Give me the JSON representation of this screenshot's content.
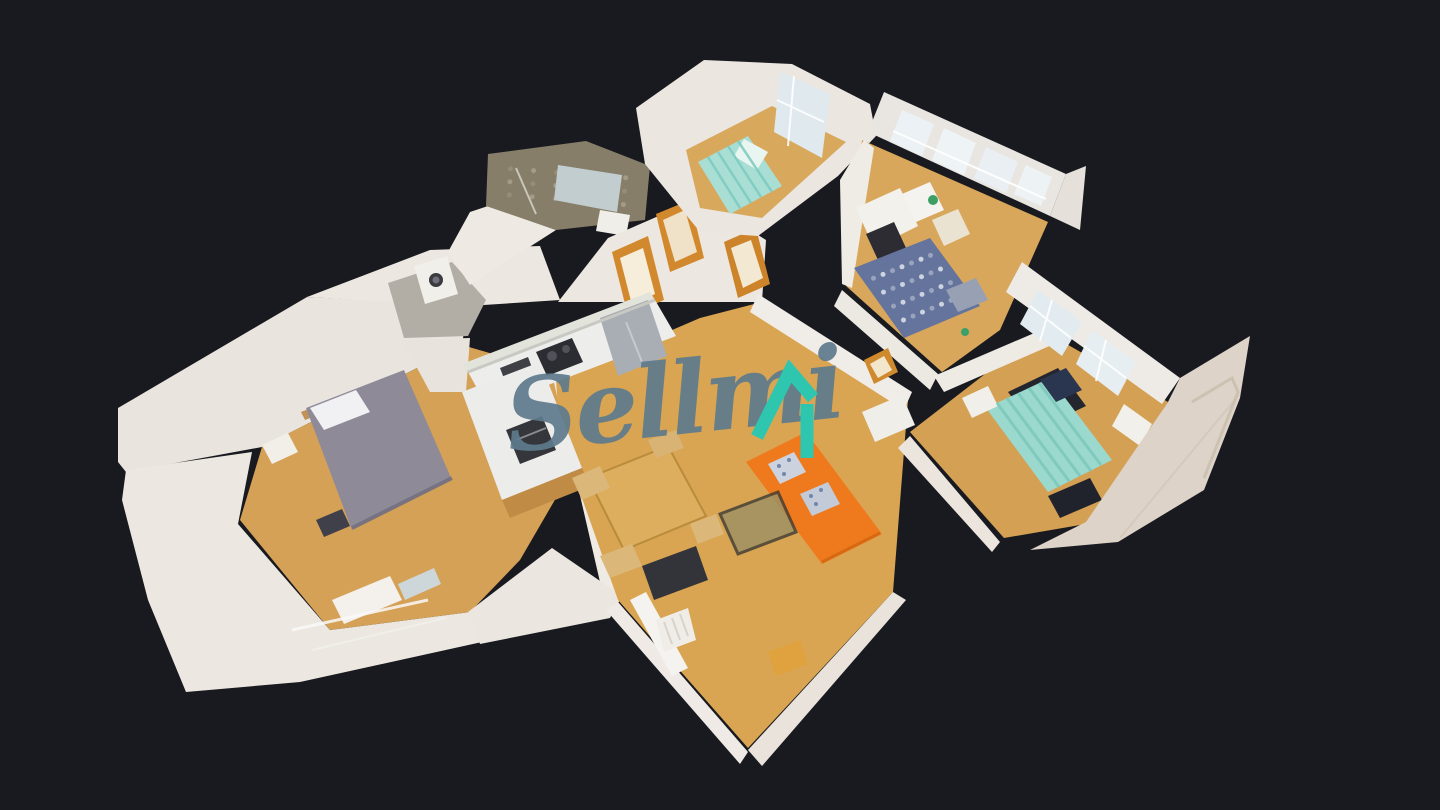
{
  "app": {
    "name": "3D dollhouse property tour viewer"
  },
  "canvas": {
    "width": 1440,
    "height": 810,
    "background": "#191a1f"
  },
  "watermark": {
    "text": "Sellmi",
    "text_color": "#5e7b8d",
    "icon_color": "#2fc6b0",
    "icon_roof_points": "757,437 790,371 813,398",
    "icon_bar_points": "807,404 807,458",
    "icon_stroke_width": 13
  },
  "scene": {
    "shapes": [
      {
        "n": "ext-wall-bedroom-nw",
        "p": "118,408 307,297 468,305 462,345 262,447 126,472 118,462",
        "f": "#e9e4de"
      },
      {
        "n": "ext-wall-bedroom-sw",
        "p": "252,452 238,524 330,630 470,612 482,642 300,682 186,692 148,600 122,500 126,470",
        "f": "#ece7e0"
      },
      {
        "n": "bedroom-floor",
        "p": "262,447 462,345 555,372 585,448 520,560 470,612 330,630 240,520",
        "f": "#d5a156"
      },
      {
        "n": "bed-headboard",
        "p": "301,412 402,372 406,380 305,420",
        "f": "#c19258"
      },
      {
        "n": "master-bed",
        "p": "306,408 404,370 452,480 352,530",
        "f": "#8f8a98"
      },
      {
        "n": "master-bed-pillows",
        "p": "310,408 356,390 370,412 324,430",
        "f": "#f1f1f3"
      },
      {
        "n": "nightstand-left",
        "p": "262,445 288,433 298,452 272,464",
        "f": "#f2efe9"
      },
      {
        "n": "bag-dark",
        "p": "316,520 342,509 350,526 324,537",
        "f": "#40404a"
      },
      {
        "n": "dresser-south",
        "p": "332,600 390,576 402,600 344,624",
        "f": "#f4f1ec"
      },
      {
        "n": "mirror-leaning",
        "p": "398,584 434,568 441,584 405,600",
        "f": "#cdd6d8"
      },
      {
        "n": "hall-upper-left-wall",
        "p": "307,297 430,250 540,246 560,300 468,306",
        "f": "#ece7e1"
      },
      {
        "n": "entry-floor-gray",
        "p": "388,283 452,262 486,300 468,336 404,338",
        "f": "#b2ada5"
      },
      {
        "n": "washing-machine",
        "p": "414,266 447,256 458,294 425,304",
        "f": "#f1efe9"
      },
      {
        "n": "entry-fill-wall",
        "p": "402,340 470,338 466,392 430,392",
        "f": "#e8e3dd"
      },
      {
        "n": "bedroom-dining-wall",
        "p": "552,374 570,366 626,594 606,608",
        "f": "#efeae4"
      },
      {
        "n": "door-frame-bedroom-outer",
        "p": "536,424 560,412 570,438 546,450",
        "f": "#cf882c"
      },
      {
        "n": "door-frame-bedroom-inner",
        "p": "542,428 556,420 564,436 550,444",
        "f": "#f4ead4"
      },
      {
        "n": "bridge-sw-wall",
        "p": "468,612 552,548 622,596 610,618 480,644",
        "f": "#ebe6e0"
      },
      {
        "n": "bath-lower-wall",
        "p": "470,212 488,206 556,230 470,285 448,252",
        "f": "#eee9e3"
      },
      {
        "n": "bath-tile-wall",
        "p": "488,154 586,141 650,166 645,220 556,230 486,206",
        "f": "#867e69",
        "pat": 1,
        "pc": "#a89f88",
        "pn": [
          7,
          4
        ],
        "pq": "488,154 650,166 645,220 486,206"
      },
      {
        "n": "bath-mirror",
        "p": "558,165 622,175 617,212 554,200",
        "f": "#c2cdd0"
      },
      {
        "n": "bath-sink",
        "p": "600,210 630,215 626,236 596,231",
        "f": "#f0eee8"
      },
      {
        "n": "hall-wall-behind-doors",
        "p": "558,302 608,238 700,198 766,240 762,302 656,302",
        "f": "#ece7e1"
      },
      {
        "n": "door-frame-1-outer",
        "p": "612,252 648,236 664,300 628,316",
        "f": "#d2892e"
      },
      {
        "n": "door-frame-1-inner",
        "p": "620,258 643,248 655,294 632,305",
        "f": "#f6edda"
      },
      {
        "n": "door-frame-2-outer",
        "p": "656,214 690,200 704,258 670,272",
        "f": "#d2892e"
      },
      {
        "n": "door-frame-2-inner",
        "p": "663,220 685,210 697,252 675,262",
        "f": "#efe2c8"
      },
      {
        "n": "door-frame-3-outer",
        "p": "724,242 756,228 770,284 738,298",
        "f": "#cc8329"
      },
      {
        "n": "door-frame-3-inner",
        "p": "731,248 751,240 763,278 743,288",
        "f": "#f3e8d2"
      },
      {
        "n": "living-floor",
        "p": "556,380 700,318 762,302 908,400 893,592 748,748 618,600 560,436",
        "f": "#d9a552"
      },
      {
        "n": "top-room-walls",
        "p": "636,108 704,60 792,64 870,104 876,136 838,176 758,236 700,232 645,164",
        "f": "#ebe6e0"
      },
      {
        "n": "top-room-floor",
        "p": "686,150 772,106 846,142 762,218 700,208",
        "f": "#d8a85c"
      },
      {
        "n": "top-room-window",
        "p": "780,72 830,94 822,158 774,132",
        "f": "#dfe9ee"
      },
      {
        "n": "top-room-bed",
        "p": "698,162 748,136 782,186 730,214",
        "f": "#a8ded4"
      },
      {
        "n": "top-room-pillow",
        "p": "744,139 768,152 757,170 734,156",
        "f": "#e9f5f1"
      },
      {
        "n": "office-window-wall",
        "p": "884,92 1066,174 1050,216 868,132",
        "f": "#e9e6e1"
      },
      {
        "n": "office-window-1",
        "p": "902,110 934,124 922,156 890,141",
        "f": "#ebf1f5"
      },
      {
        "n": "office-window-2",
        "p": "944,128 976,143 964,175 932,160",
        "f": "#eef3f6"
      },
      {
        "n": "office-window-3",
        "p": "986,147 1018,162 1006,193 974,178",
        "f": "#e9eff3"
      },
      {
        "n": "office-window-4",
        "p": "1026,165 1052,177 1041,206 1014,194",
        "f": "#edf2f5"
      },
      {
        "n": "office-right-wall",
        "p": "1066,174 1086,166 1080,230 1050,216",
        "f": "#e5e0da"
      },
      {
        "n": "office-floor",
        "p": "862,140 1048,222 1000,330 942,372 846,286",
        "f": "#d9a75b"
      },
      {
        "n": "office-left-wall",
        "p": "840,180 864,140 874,148 852,288 842,284",
        "f": "#efebe5"
      },
      {
        "n": "office-desk",
        "p": "856,208 900,188 918,226 874,248",
        "f": "#f3f1ec"
      },
      {
        "n": "office-chair",
        "p": "866,234 894,222 906,248 878,260",
        "f": "#2c2c32"
      },
      {
        "n": "office-drawers",
        "p": "902,194 930,182 944,210 916,222",
        "f": "#f5f3ef"
      },
      {
        "n": "wicker-chair",
        "p": "932,220 958,209 970,234 944,246",
        "f": "#eae3d2"
      },
      {
        "n": "office-bed-checker",
        "p": "854,268 930,238 980,306 904,338",
        "f": "#64749c",
        "pat": 1,
        "pc": "#d9dee9",
        "pn": [
          8,
          5
        ]
      },
      {
        "n": "office-bed-pillow",
        "p": "946,290 976,278 988,300 958,312",
        "f": "#98a0b4"
      },
      {
        "n": "living-office-wall",
        "p": "758,294 912,392 904,410 750,312",
        "f": "#f0ece7"
      },
      {
        "n": "corridor-wall",
        "p": "842,290 938,374 930,390 834,306",
        "f": "#ece8e2"
      },
      {
        "n": "corridor-table",
        "p": "862,412 902,395 915,425 875,442",
        "f": "#f0eee9"
      },
      {
        "n": "door-frame-right-outer",
        "p": "864,360 888,348 898,372 874,384",
        "f": "#d08a2e"
      },
      {
        "n": "door-frame-right-inner",
        "p": "870,364 884,356 892,370 878,378",
        "f": "#f2e6cc"
      },
      {
        "n": "right-room-floor",
        "p": "910,432 1042,330 1168,402 1086,524 1004,538",
        "f": "#d4a054"
      },
      {
        "n": "right-rooms-wall",
        "p": "934,376 1046,328 1054,344 944,392",
        "f": "#eeeae4"
      },
      {
        "n": "floor-shadow-1",
        "p": "1008,392 1058,368 1086,406 1036,430",
        "f": "#23262e"
      },
      {
        "n": "floor-shadow-2",
        "p": "1048,496 1090,478 1102,500 1060,518",
        "f": "#20232b"
      },
      {
        "n": "right-bed-teal",
        "p": "986,408 1050,378 1112,460 1048,492",
        "f": "#9bd8cd"
      },
      {
        "n": "right-bed-pillow",
        "p": "1040,380 1066,368 1082,390 1056,402",
        "f": "#2a3550"
      },
      {
        "n": "nightstand-right",
        "p": "962,398 988,386 998,406 972,418",
        "f": "#f1efe9"
      },
      {
        "n": "right-window-wall",
        "p": "1022,262 1180,378 1162,404 1006,292",
        "f": "#eeebe6"
      },
      {
        "n": "right-window-1",
        "p": "1038,290 1082,322 1062,356 1020,324",
        "f": "#e2ebf0"
      },
      {
        "n": "right-window-2",
        "p": "1092,330 1136,362 1118,396 1076,364",
        "f": "#e6eef2"
      },
      {
        "n": "right-radiator",
        "p": "1124,404 1152,424 1140,446 1112,426",
        "f": "#f2f0ea"
      },
      {
        "n": "ext-wall-right",
        "p": "1168,402 1180,378 1250,336 1240,398 1204,490 1118,542 1030,550 1086,522",
        "f": "#ddd3c8"
      },
      {
        "n": "corridor-south-wall",
        "p": "910,436 1000,542 992,552 898,448",
        "f": "#ebe5de"
      },
      {
        "n": "kitchen-backsplash",
        "p": "462,364 650,292 655,300 468,372",
        "f": "#e2e4db"
      },
      {
        "n": "kitchen-counter",
        "p": "468,372 655,300 676,336 488,408",
        "f": "#ededeb"
      },
      {
        "n": "fridge",
        "p": "600,318 648,300 667,356 618,376",
        "f": "#a9aeb4"
      },
      {
        "n": "cooktop",
        "p": "536,352 572,338 583,362 547,376",
        "f": "#2c2d33"
      },
      {
        "n": "microwave",
        "p": "500,368 528,357 536,378 508,389",
        "f": "#3f4046"
      },
      {
        "n": "kitchen-island",
        "p": "462,392 540,362 582,468 502,500",
        "f": "#ececea"
      },
      {
        "n": "island-wood-base",
        "p": "502,500 582,468 590,486 510,518",
        "f": "#c08c45"
      },
      {
        "n": "oven",
        "p": "506,430 542,416 556,450 520,464",
        "f": "#35363c"
      },
      {
        "n": "living-sw-wall",
        "p": "618,602 748,752 740,764 606,610",
        "f": "#efeae5"
      },
      {
        "n": "living-se-wall",
        "p": "893,592 906,600 762,766 748,750",
        "f": "#e9e3dc"
      },
      {
        "n": "living-mirror",
        "p": "630,600 646,592 688,668 672,676",
        "f": "#f5f3ef"
      },
      {
        "n": "dining-table",
        "p": "588,478 668,446 706,516 624,550",
        "f": "#dcae5e",
        "s": "#b98b3c",
        "sw": 2
      },
      {
        "n": "dining-chair-1",
        "p": "572,478 600,466 610,488 582,500",
        "f": "#dbb779"
      },
      {
        "n": "dining-chair-2",
        "p": "600,556 632,544 642,566 610,578",
        "f": "#dbb779"
      },
      {
        "n": "dining-chair-3",
        "p": "690,524 716,514 724,534 698,544",
        "f": "#dbb779"
      },
      {
        "n": "dining-chair-4",
        "p": "648,440 676,430 684,448 656,458",
        "f": "#d8b374"
      },
      {
        "n": "tv-bench",
        "p": "642,566 696,546 708,580 654,600",
        "f": "#33343a"
      },
      {
        "n": "rug-amber",
        "p": "768,652 800,640 808,664 776,676",
        "f": "#dfa23e"
      },
      {
        "n": "living-radiator",
        "p": "656,620 688,608 696,640 664,652",
        "f": "#f0ede8"
      },
      {
        "n": "sofa-orange",
        "p": "746,462 806,432 882,534 822,564",
        "f": "#ef7a1e"
      },
      {
        "n": "sofa-cushion-1",
        "p": "768,464 794,452 806,472 780,484",
        "f": "#ccd2de"
      },
      {
        "n": "sofa-cushion-2",
        "p": "800,494 828,482 840,504 812,516",
        "f": "#c3cad8"
      },
      {
        "n": "coffee-table",
        "p": "720,514 778,492 796,532 738,554",
        "f": "#9b9064",
        "o": 0.8,
        "s": "#3b3a36",
        "sw": 3
      }
    ],
    "lines": [
      [
        777,
        100,
        824,
        122,
        "#ffffff",
        2,
        0.9
      ],
      [
        794,
        76,
        788,
        146,
        "#ffffff",
        2,
        0.9
      ],
      [
        893,
        131,
        1046,
        199,
        "#ffffff",
        2,
        0.95
      ],
      [
        1030,
        306,
        1071,
        338,
        "#ffffff",
        2,
        0.9
      ],
      [
        1052,
        300,
        1040,
        341,
        "#ffffff",
        2,
        0.9
      ],
      [
        1084,
        346,
        1126,
        378,
        "#ffffff",
        2,
        0.9
      ],
      [
        1106,
        340,
        1096,
        381,
        "#ffffff",
        2,
        0.9
      ],
      [
        468,
        372,
        655,
        300,
        "#c9c9c3",
        3,
        1
      ],
      [
        626,
        322,
        642,
        362,
        "#c9cdd2",
        2,
        0.9
      ],
      [
        516,
        440,
        546,
        428,
        "#8a8a90",
        2,
        1
      ],
      [
        664,
        622,
        672,
        644,
        "#d8d3cb",
        2,
        1
      ],
      [
        672,
        618,
        680,
        640,
        "#d8d3cb",
        2,
        1
      ],
      [
        680,
        614,
        688,
        636,
        "#d8d3cb",
        2,
        1
      ],
      [
        516,
        168,
        536,
        214,
        "#ffffff",
        2,
        0.55
      ],
      [
        292,
        630,
        428,
        600,
        "#fafafa",
        3,
        0.85
      ],
      [
        312,
        650,
        446,
        618,
        "#f5f5f2",
        2,
        0.6
      ],
      [
        997,
        403,
        1059,
        487,
        "#7bc8bb",
        3,
        0.85
      ],
      [
        1007,
        398,
        1069,
        481,
        "#7bc8bb",
        3,
        0.85
      ],
      [
        1018,
        393,
        1080,
        476,
        "#7bc8bb",
        3,
        0.85
      ],
      [
        1029,
        388,
        1091,
        471,
        "#7bc8bb",
        3,
        0.85
      ],
      [
        1039,
        383,
        1101,
        465,
        "#7bc8bb",
        3,
        0.85
      ],
      [
        708,
        157,
        740,
        208,
        "#7ccabe",
        2.5,
        0.85
      ],
      [
        718,
        152,
        751,
        203,
        "#7ccabe",
        2.5,
        0.85
      ],
      [
        728,
        146,
        761,
        197,
        "#7ccabe",
        2.5,
        0.85
      ],
      [
        738,
        141,
        772,
        192,
        "#7ccabe",
        2.5,
        0.85
      ],
      [
        352,
        528,
        452,
        478,
        "#6f6a78",
        4,
        0.7
      ],
      [
        822,
        562,
        880,
        533,
        "#d2660e",
        3,
        0.8
      ],
      [
        1238,
        396,
        1120,
        538,
        "#cfc3b6",
        2,
        0.6
      ]
    ],
    "dots": [
      [
        436,
        280,
        7,
        "#3a3a40"
      ],
      [
        436,
        280,
        3.5,
        "#70707a"
      ],
      [
        552,
        356,
        5,
        "#50525a"
      ],
      [
        566,
        349,
        4,
        "#50525a"
      ],
      [
        933,
        200,
        5,
        "#3d9e66"
      ],
      [
        965,
        332,
        4,
        "#3aa06a"
      ],
      [
        779,
        466,
        2,
        "#7186ac"
      ],
      [
        789,
        460,
        2,
        "#7186ac"
      ],
      [
        784,
        474,
        2,
        "#7186ac"
      ],
      [
        811,
        496,
        2,
        "#7186ac"
      ],
      [
        821,
        490,
        2,
        "#7186ac"
      ],
      [
        816,
        504,
        2,
        "#7186ac"
      ]
    ],
    "strokes": [
      {
        "n": "heating-pipes",
        "p": "1192,402 1232,378 1238,392 1204,478",
        "c": "#cbbfae",
        "w": 3,
        "o": 0.9
      }
    ]
  }
}
